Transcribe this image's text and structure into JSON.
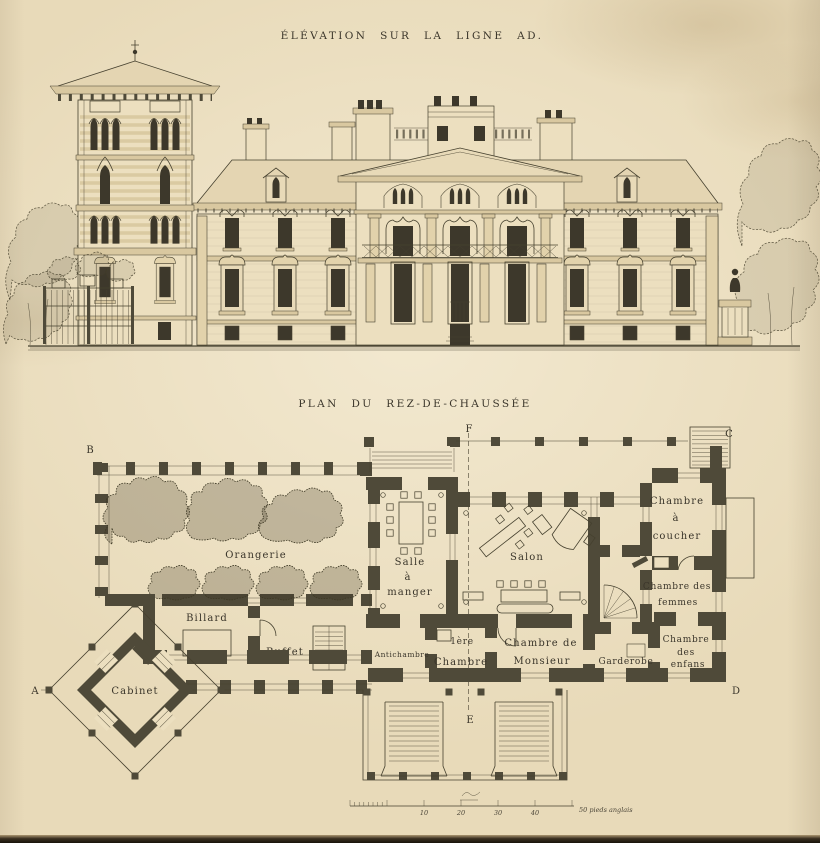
{
  "palette": {
    "paper": "#e9dbbb",
    "ink": "#3c372a",
    "wall": "#4f4a39",
    "window_dark": "#3d382b"
  },
  "elevation": {
    "title": "ÉLÉVATION SUR LA LIGNE AD."
  },
  "plan": {
    "title": "PLAN DU REZ-DE-CHAUSSÉE",
    "markers": {
      "a": "A",
      "b": "B",
      "c": "C",
      "d": "D",
      "e": "E",
      "f": "F"
    },
    "rooms": {
      "orangerie": "Orangerie",
      "billard": "Billard",
      "buffet": "Buffet",
      "cabinet": "Cabinet",
      "salle_1": "Salle",
      "salle_2": "à",
      "salle_3": "manger",
      "salon": "Salon",
      "antichambre": "Antichambre",
      "premiere_1": "1ère",
      "premiere_2": "Chambre",
      "monsieur_1": "Chambre de",
      "monsieur_2": "Monsieur",
      "coucher_1": "Chambre",
      "coucher_2": "à",
      "coucher_3": "coucher",
      "femmes_1": "Chambre des",
      "femmes_2": "femmes",
      "garderobe": "Garderobe",
      "enfans_1": "Chambre",
      "enfans_2": "des",
      "enfans_3": "enfans"
    },
    "scale": {
      "t10": "10",
      "t20": "20",
      "t30": "30",
      "t40": "40",
      "end": "50 pieds anglais"
    }
  }
}
